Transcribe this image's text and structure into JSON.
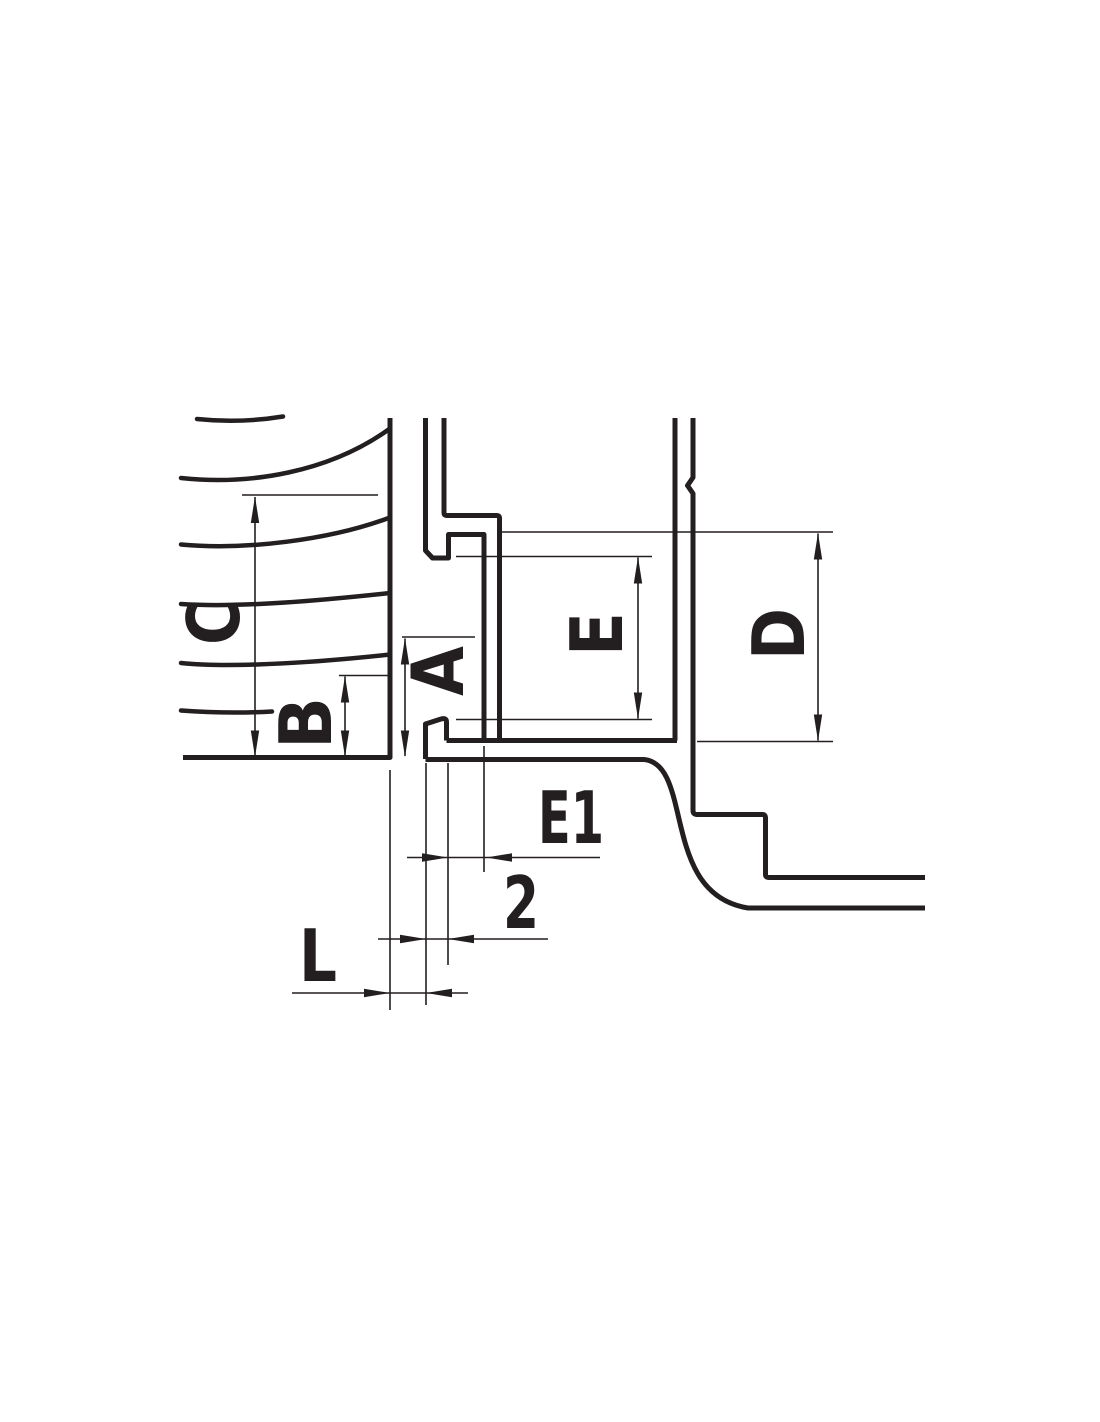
{
  "drawing": {
    "kind": "technical cross-section dimension drawing",
    "line_color": "#231f20",
    "background_color": "#ffffff",
    "labels": {
      "a": "A",
      "b": "B",
      "c": "C",
      "d": "D",
      "e": "E",
      "e1": "E1",
      "two": "2",
      "l": "L"
    }
  }
}
